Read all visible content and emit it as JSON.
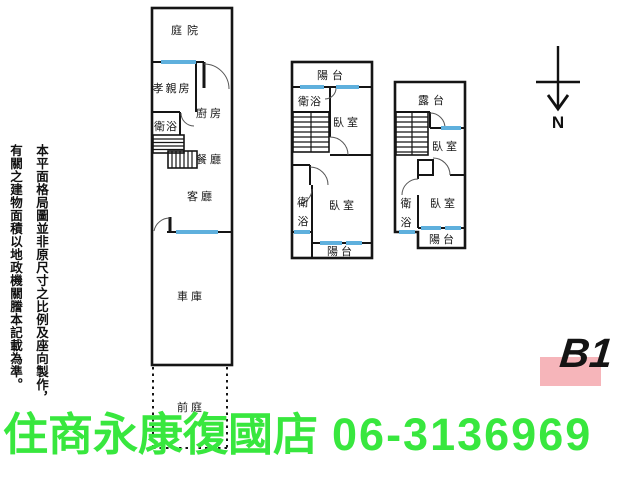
{
  "colors": {
    "wall": "#151515",
    "window": "#5fb0dd",
    "badge_bg": "#f6b5ba",
    "brand_green": "#38e73e"
  },
  "disclaimer": {
    "column_right": "本平面格局圖並非原尺寸之比例及座向製作，",
    "column_left": "有關之建物面積以地政機關謄本記載為準。"
  },
  "compass": {
    "label": "N"
  },
  "floor_badge": {
    "label": "B1"
  },
  "footer": {
    "store_name": "住商永康復國店",
    "phone": "06-3136969"
  },
  "plan1f": {
    "courtyard": "庭院",
    "parents_room": "孝親房",
    "kitchen": "廚房",
    "bathroom": "衛浴",
    "dining_room": "餐廳",
    "living_room": "客廳",
    "garage": "車庫",
    "front_yard": "前庭"
  },
  "plan2f": {
    "balcony_front": "陽台",
    "bathroom_front": "衛浴",
    "bedroom_front": "臥室",
    "bathroom_rear_char1": "衛",
    "bathroom_rear_char2": "浴",
    "bedroom_rear": "臥室",
    "balcony_rear": "陽台"
  },
  "plan3f": {
    "terrace": "露台",
    "bedroom_front": "臥室",
    "bathroom_char1": "衛",
    "bathroom_char2": "浴",
    "bedroom_rear": "臥室",
    "balcony": "陽台"
  }
}
